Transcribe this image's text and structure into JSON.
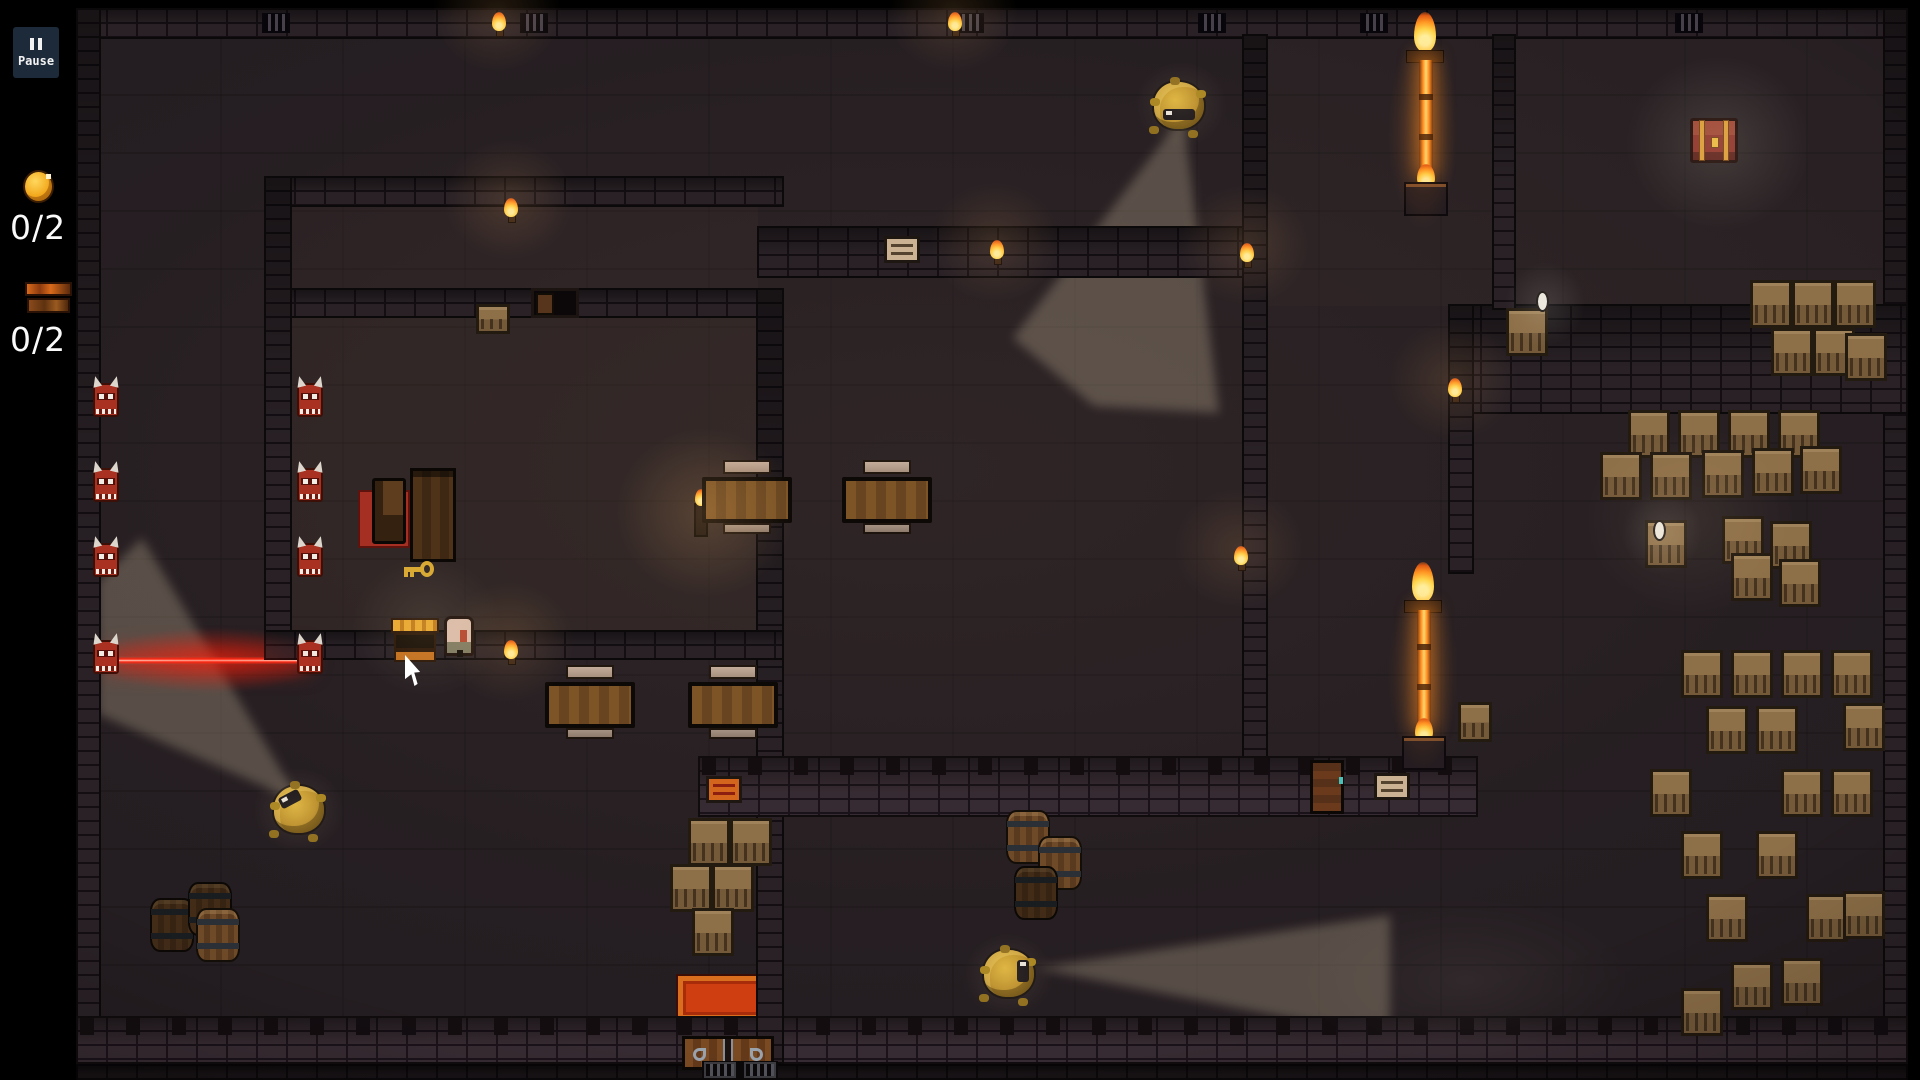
{
  "hud": {
    "pause": {
      "icon": "pause-bars",
      "label": "Pause"
    },
    "counters": [
      {
        "name": "coins",
        "icon": "coin-icon",
        "value": "0/2"
      },
      {
        "name": "chests",
        "icon": "chest-icon",
        "value": "0/2"
      }
    ]
  },
  "colors": {
    "background": "#000000",
    "floor": "#241d21",
    "wall": "#2e252a",
    "vision_cone": "#cdbb9d",
    "laser": "#ff2a14",
    "fire": "#ff8c1e",
    "guard_hair": "#c9a02c",
    "demon_red": "#a93122",
    "crate": "#8d6f48",
    "gold": "#d8a832",
    "hud_pause_bg": "#1c2a3a",
    "text": "#fafafa"
  },
  "world": {
    "tints": [
      {
        "x": 292,
        "y": 318,
        "w": 466,
        "h": 312,
        "c": "rgba(110,80,60,0.12)"
      },
      {
        "x": 292,
        "y": 205,
        "w": 466,
        "h": 83,
        "c": "rgba(110,80,60,0.08)"
      },
      {
        "x": 1266,
        "y": 38,
        "w": 618,
        "h": 268,
        "c": "rgba(100,85,75,0.07)"
      }
    ],
    "cones": [
      {
        "points": "1183,115 1013,338 1094,406 1219,413"
      },
      {
        "points": "300,802 142,538 98,582 98,714"
      },
      {
        "points": "1035,968 1390,915 1390,1038"
      }
    ],
    "laser": {
      "x": 112,
      "y": 656,
      "w": 192,
      "h": 9
    },
    "walls": [
      {
        "x": 78,
        "y": 10,
        "w": 1828,
        "h": 27,
        "v": ""
      },
      {
        "x": 78,
        "y": 10,
        "w": 21,
        "h": 1052,
        "v": ""
      },
      {
        "x": 1885,
        "y": 10,
        "w": 21,
        "h": 1052,
        "v": ""
      },
      {
        "x": 78,
        "y": 1018,
        "w": 1828,
        "h": 44,
        "v": "lit",
        "t": true
      },
      {
        "x": 78,
        "y": 1066,
        "w": 1828,
        "h": 14,
        "v": "dim"
      },
      {
        "x": 266,
        "y": 178,
        "w": 516,
        "h": 27,
        "v": ""
      },
      {
        "x": 759,
        "y": 228,
        "w": 500,
        "h": 48,
        "v": ""
      },
      {
        "x": 266,
        "y": 290,
        "w": 265,
        "h": 26,
        "v": ""
      },
      {
        "x": 578,
        "y": 290,
        "w": 203,
        "h": 26,
        "v": ""
      },
      {
        "x": 266,
        "y": 178,
        "w": 24,
        "h": 480,
        "v": ""
      },
      {
        "x": 758,
        "y": 290,
        "w": 24,
        "h": 772,
        "v": ""
      },
      {
        "x": 266,
        "y": 632,
        "w": 516,
        "h": 26,
        "v": ""
      },
      {
        "x": 1244,
        "y": 36,
        "w": 22,
        "h": 722,
        "v": ""
      },
      {
        "x": 700,
        "y": 758,
        "w": 776,
        "h": 57,
        "v": "lit",
        "t": true
      },
      {
        "x": 1452,
        "y": 306,
        "w": 454,
        "h": 106,
        "v": ""
      },
      {
        "x": 1494,
        "y": 36,
        "w": 20,
        "h": 272,
        "v": ""
      },
      {
        "x": 1450,
        "y": 306,
        "w": 22,
        "h": 266,
        "v": ""
      }
    ],
    "vents": [
      {
        "x": 262,
        "y": 13
      },
      {
        "x": 520,
        "y": 13
      },
      {
        "x": 956,
        "y": 13
      },
      {
        "x": 1198,
        "y": 13
      },
      {
        "x": 1360,
        "y": 13
      },
      {
        "x": 1675,
        "y": 13
      }
    ],
    "demons": [
      {
        "x": 93,
        "y": 383
      },
      {
        "x": 297,
        "y": 383
      },
      {
        "x": 93,
        "y": 468
      },
      {
        "x": 297,
        "y": 468
      },
      {
        "x": 93,
        "y": 543
      },
      {
        "x": 297,
        "y": 543
      },
      {
        "x": 93,
        "y": 640
      },
      {
        "x": 297,
        "y": 640
      }
    ],
    "guards": [
      {
        "x": 1154,
        "y": 82,
        "dir": "s"
      },
      {
        "x": 274,
        "y": 786,
        "dir": "nw"
      },
      {
        "x": 984,
        "y": 950,
        "dir": "e"
      }
    ],
    "torches": [
      {
        "x": 492,
        "y": 12
      },
      {
        "x": 948,
        "y": 12
      },
      {
        "x": 504,
        "y": 198
      },
      {
        "x": 504,
        "y": 640
      },
      {
        "x": 990,
        "y": 240
      },
      {
        "x": 1240,
        "y": 243
      },
      {
        "x": 1448,
        "y": 378
      },
      {
        "x": 1234,
        "y": 546
      }
    ],
    "fire_barriers": [
      {
        "x": 1408,
        "y": 12,
        "beam": 112
      },
      {
        "x": 1406,
        "y": 562,
        "beam": 116
      }
    ],
    "tables": [
      {
        "x": 702,
        "y": 477
      },
      {
        "x": 842,
        "y": 477
      },
      {
        "x": 545,
        "y": 682
      },
      {
        "x": 688,
        "y": 682
      }
    ],
    "crates": [
      {
        "x": 1750,
        "y": 280
      },
      {
        "x": 1792,
        "y": 280
      },
      {
        "x": 1834,
        "y": 280
      },
      {
        "x": 1771,
        "y": 328
      },
      {
        "x": 1813,
        "y": 328
      },
      {
        "x": 1845,
        "y": 333
      },
      {
        "x": 1506,
        "y": 308
      },
      {
        "x": 1458,
        "y": 702,
        "w": 34,
        "h": 40
      },
      {
        "x": 476,
        "y": 304,
        "w": 34,
        "h": 30
      },
      {
        "x": 1628,
        "y": 410
      },
      {
        "x": 1678,
        "y": 410
      },
      {
        "x": 1728,
        "y": 410
      },
      {
        "x": 1778,
        "y": 410
      },
      {
        "x": 1600,
        "y": 452
      },
      {
        "x": 1650,
        "y": 452
      },
      {
        "x": 1702,
        "y": 450
      },
      {
        "x": 1752,
        "y": 448
      },
      {
        "x": 1800,
        "y": 446
      },
      {
        "x": 1645,
        "y": 520
      },
      {
        "x": 1722,
        "y": 516
      },
      {
        "x": 1770,
        "y": 521
      },
      {
        "x": 1731,
        "y": 553
      },
      {
        "x": 1779,
        "y": 559
      },
      {
        "x": 688,
        "y": 818
      },
      {
        "x": 730,
        "y": 818
      },
      {
        "x": 670,
        "y": 864
      },
      {
        "x": 712,
        "y": 864
      },
      {
        "x": 692,
        "y": 908
      },
      {
        "x": 1681,
        "y": 650
      },
      {
        "x": 1731,
        "y": 650
      },
      {
        "x": 1781,
        "y": 650
      },
      {
        "x": 1831,
        "y": 650
      },
      {
        "x": 1706,
        "y": 706
      },
      {
        "x": 1756,
        "y": 706
      },
      {
        "x": 1843,
        "y": 703
      },
      {
        "x": 1650,
        "y": 769
      },
      {
        "x": 1781,
        "y": 769
      },
      {
        "x": 1831,
        "y": 769
      },
      {
        "x": 1681,
        "y": 831
      },
      {
        "x": 1756,
        "y": 831
      },
      {
        "x": 1706,
        "y": 894
      },
      {
        "x": 1806,
        "y": 894
      },
      {
        "x": 1843,
        "y": 891
      },
      {
        "x": 1731,
        "y": 962
      },
      {
        "x": 1781,
        "y": 958
      },
      {
        "x": 1681,
        "y": 988
      }
    ],
    "barrels": [
      {
        "x": 150,
        "y": 898,
        "v": "dim"
      },
      {
        "x": 188,
        "y": 882,
        "v": "dim"
      },
      {
        "x": 196,
        "y": 908,
        "v": ""
      },
      {
        "x": 1006,
        "y": 810,
        "v": ""
      },
      {
        "x": 1038,
        "y": 836,
        "v": ""
      },
      {
        "x": 1014,
        "y": 866,
        "v": "dim"
      }
    ],
    "signs": [
      {
        "x": 884,
        "y": 236,
        "v": "tan"
      },
      {
        "x": 706,
        "y": 776,
        "v": "orange"
      },
      {
        "x": 1374,
        "y": 773,
        "v": "tan"
      }
    ],
    "chests": [
      {
        "x": 391,
        "y": 618,
        "type": "open"
      },
      {
        "x": 1690,
        "y": 118,
        "type": "closed"
      }
    ],
    "key": {
      "x": 402,
      "y": 560
    },
    "player": {
      "x": 444,
      "y": 616
    },
    "eggs": [
      {
        "x": 1536,
        "y": 291
      },
      {
        "x": 1653,
        "y": 520
      }
    ],
    "doors": [
      {
        "x": 682,
        "y": 1036,
        "type": "bottom"
      },
      {
        "x": 1310,
        "y": 760,
        "type": "right"
      },
      {
        "x": 531,
        "y": 288,
        "type": "doorway"
      }
    ],
    "gate": {
      "x": 702,
      "y": 1061
    },
    "rug": {
      "x": 678,
      "y": 976
    },
    "bed": {
      "rug": {
        "x": 358,
        "y": 490
      },
      "chair": {
        "x": 372,
        "y": 478
      }
    },
    "wardrobe": {
      "x": 410,
      "y": 468
    },
    "candle": {
      "x": 694,
      "y": 503
    },
    "cursor": {
      "x": 405,
      "y": 655
    },
    "glows": [
      {
        "x": 432,
        "y": -48,
        "w": 130,
        "h": 120,
        "c": "rgba(255,180,100,0.14)"
      },
      {
        "x": 888,
        "y": -48,
        "w": 130,
        "h": 120,
        "c": "rgba(255,180,100,0.14)"
      },
      {
        "x": 444,
        "y": 140,
        "w": 130,
        "h": 120,
        "c": "rgba(255,180,100,0.14)"
      },
      {
        "x": 444,
        "y": 582,
        "w": 130,
        "h": 120,
        "c": "rgba(255,180,100,0.14)"
      },
      {
        "x": 930,
        "y": 182,
        "w": 130,
        "h": 120,
        "c": "rgba(255,180,100,0.13)"
      },
      {
        "x": 1180,
        "y": 185,
        "w": 130,
        "h": 120,
        "c": "rgba(255,180,100,0.13)"
      },
      {
        "x": 1388,
        "y": 320,
        "w": 130,
        "h": 120,
        "c": "rgba(255,180,100,0.13)"
      },
      {
        "x": 1174,
        "y": 488,
        "w": 130,
        "h": 120,
        "c": "rgba(255,180,100,0.12)"
      },
      {
        "x": 615,
        "y": 428,
        "w": 180,
        "h": 170,
        "c": "rgba(255,190,110,0.18)"
      },
      {
        "x": 96,
        "y": 626,
        "w": 230,
        "h": 68,
        "c": "rgba(255,30,10,0.28)"
      },
      {
        "x": 1388,
        "y": 30,
        "w": 70,
        "h": 200,
        "c": "rgba(255,140,40,0.22)"
      },
      {
        "x": 1388,
        "y": 580,
        "w": 70,
        "h": 190,
        "c": "rgba(255,140,40,0.22)"
      },
      {
        "x": 1626,
        "y": 56,
        "w": 185,
        "h": 175,
        "c": "rgba(255,235,210,0.13)"
      },
      {
        "x": 1505,
        "y": 262,
        "w": 80,
        "h": 85,
        "c": "rgba(255,255,240,0.11)"
      },
      {
        "x": 1622,
        "y": 490,
        "w": 80,
        "h": 85,
        "c": "rgba(255,255,240,0.10)"
      },
      {
        "x": 1135,
        "y": 62,
        "w": 92,
        "h": 86,
        "c": "rgba(255,220,160,0.10)"
      },
      {
        "x": 252,
        "y": 768,
        "w": 92,
        "h": 86,
        "c": "rgba(255,220,160,0.10)"
      },
      {
        "x": 962,
        "y": 932,
        "w": 92,
        "h": 86,
        "c": "rgba(255,220,160,0.10)"
      },
      {
        "x": 352,
        "y": 556,
        "w": 150,
        "h": 140,
        "c": "rgba(255,220,170,0.10)"
      },
      {
        "x": 1585,
        "y": 425,
        "w": 210,
        "h": 190,
        "c": "rgba(255,215,160,0.08)"
      },
      {
        "x": 1300,
        "y": 898,
        "w": 330,
        "h": 165,
        "c": "rgba(190,170,150,0.08)"
      }
    ]
  }
}
